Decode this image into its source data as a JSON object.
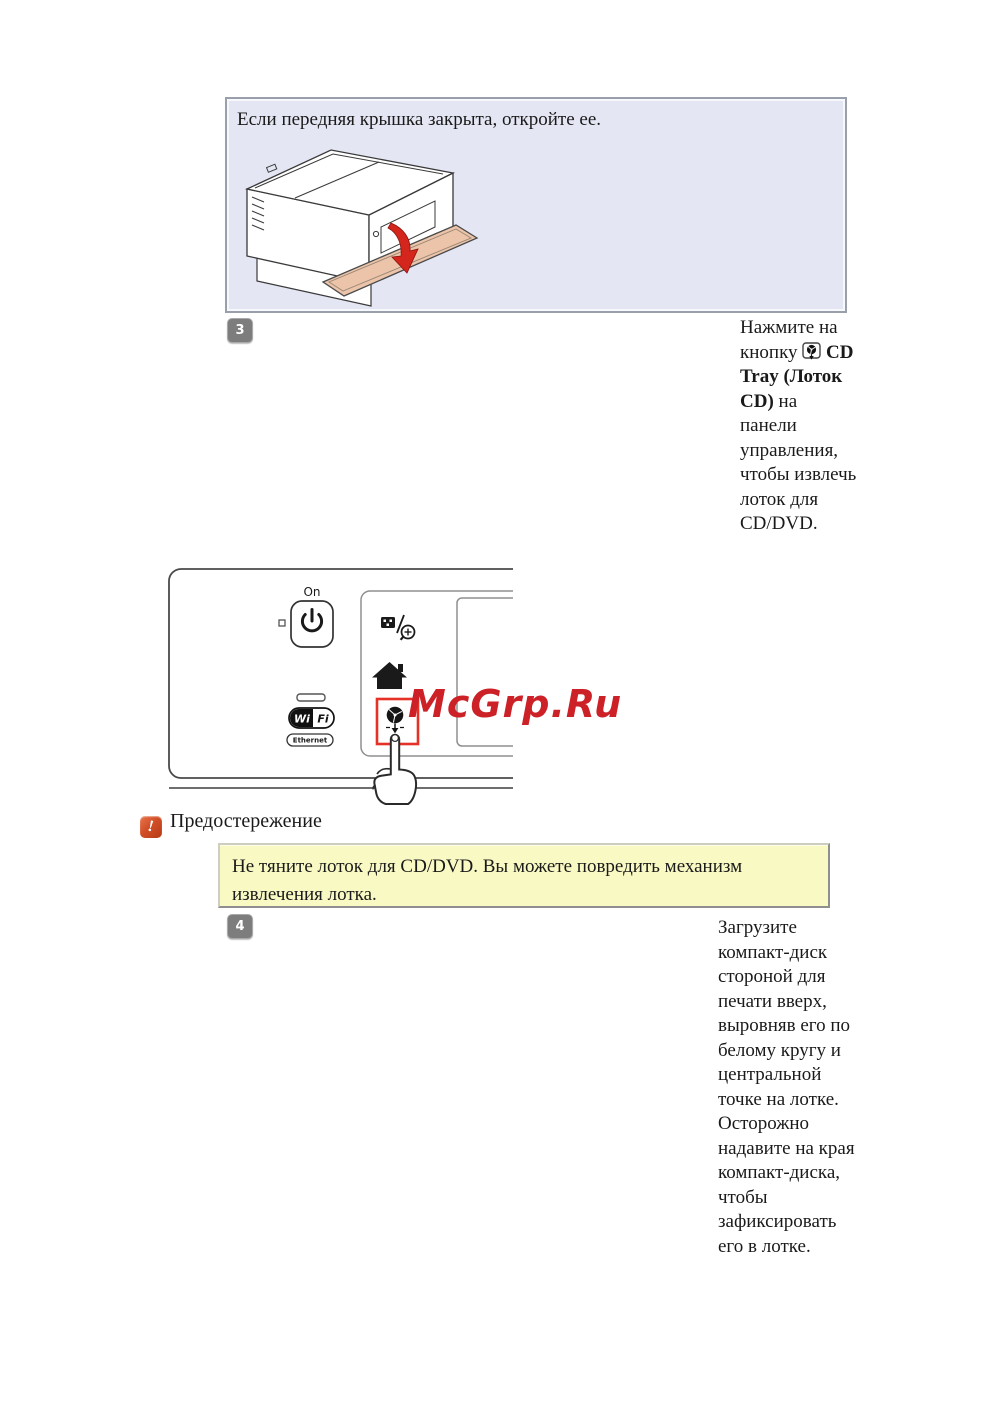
{
  "watermark": {
    "text": "McGrp.Ru"
  },
  "info_box": {
    "text": "Если передняя крышка закрыта, откройте ее."
  },
  "step3": {
    "number": "3",
    "text_before_icon": "Нажмите на кнопку",
    "button_bold_label": "CD Tray (Лоток CD)",
    "text_after_bold": "на панели управления, чтобы извлечь лоток для CD/DVD."
  },
  "step4": {
    "number": "4",
    "text": "Загрузите компакт-диск стороной для печати вверх, выровняв его по белому кругу и центральной точке на лотке. Осторожно надавите на края компакт-диска, чтобы зафиксировать его в лотке."
  },
  "caution": {
    "label": "Предостережение",
    "text": "Не тяните лоток для CD/DVD. Вы можете повредить механизм извлечения лотка."
  },
  "control_panel": {
    "on_label": "On",
    "wifi_left": "Wi",
    "wifi_right": "Fi",
    "ethernet_label": "Ethernet"
  },
  "colors": {
    "info_box_bg": "#e4e6f3",
    "note_bg": "#f9f9c4",
    "watermark_red": "#cc2127",
    "highlight_red": "#e53126",
    "arrow_red": "#d4261c",
    "badge_gray": "#7d7d7d"
  }
}
